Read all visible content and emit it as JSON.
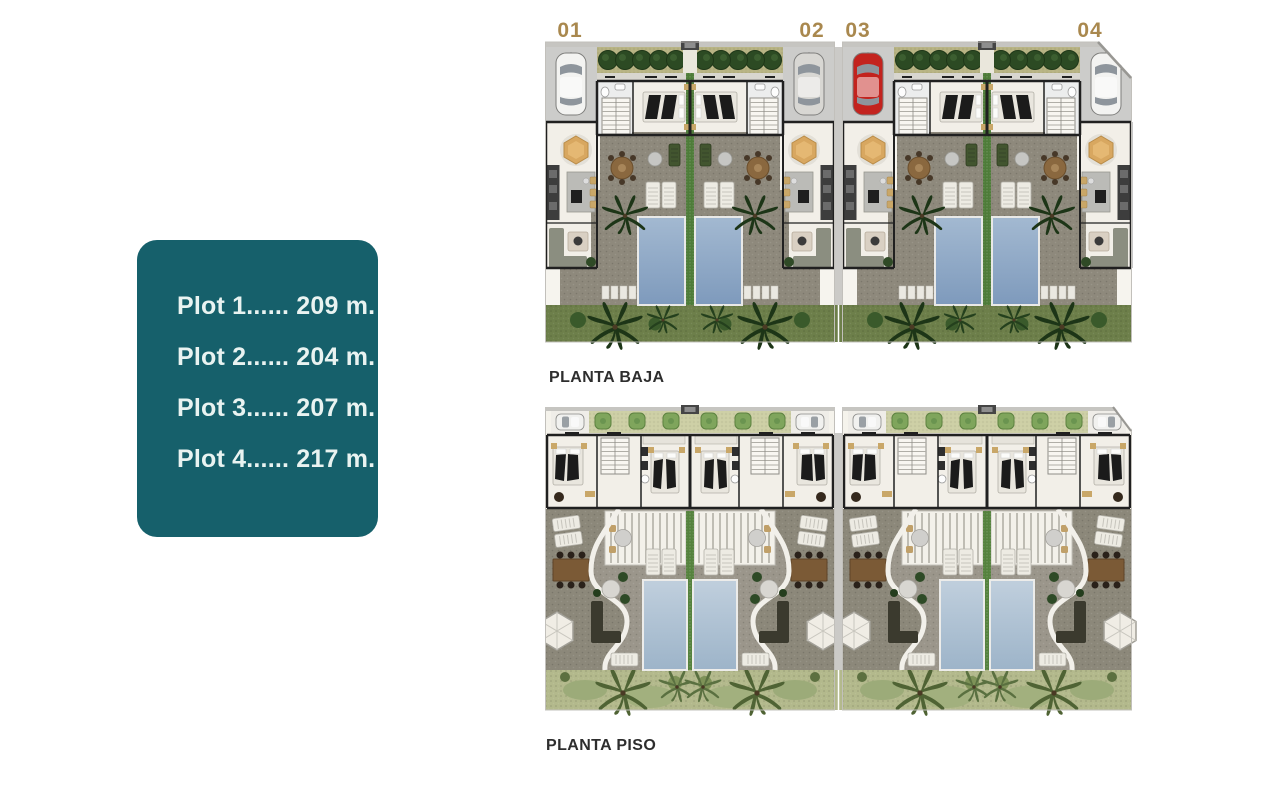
{
  "legend": {
    "bg_color": "#16606b",
    "text_color": "#e9f3f1",
    "items": [
      {
        "label": "Plot 1...... 209 m."
      },
      {
        "label": "Plot 2...... 204 m."
      },
      {
        "label": "Plot 3...... 207 m."
      },
      {
        "label": "Plot 4...... 217 m."
      }
    ]
  },
  "plot_markers": [
    {
      "id": "01"
    },
    {
      "id": "02"
    },
    {
      "id": "03"
    },
    {
      "id": "04"
    }
  ],
  "floor_plans": [
    {
      "name": "planta-baja",
      "label": "PLANTA BAJA"
    },
    {
      "name": "planta-piso",
      "label": "PLANTA PISO"
    }
  ],
  "colors": {
    "accent_teal": "#16606b",
    "plot_number_tan": "#a9884e",
    "label_text": "#2e2e2e",
    "pool_ground_floor": "#7e9abc",
    "pool_upper_floor": "#9db4c9",
    "patio_stone": "#8e897c",
    "grass_ground_floor": "#6d7f4a",
    "grass_upper_floor": "#b3b98c",
    "hedge": "#b7b383",
    "car_red": "#c3231e",
    "car_silver": "#d8d7d3",
    "car_white": "#f3f3f1"
  }
}
